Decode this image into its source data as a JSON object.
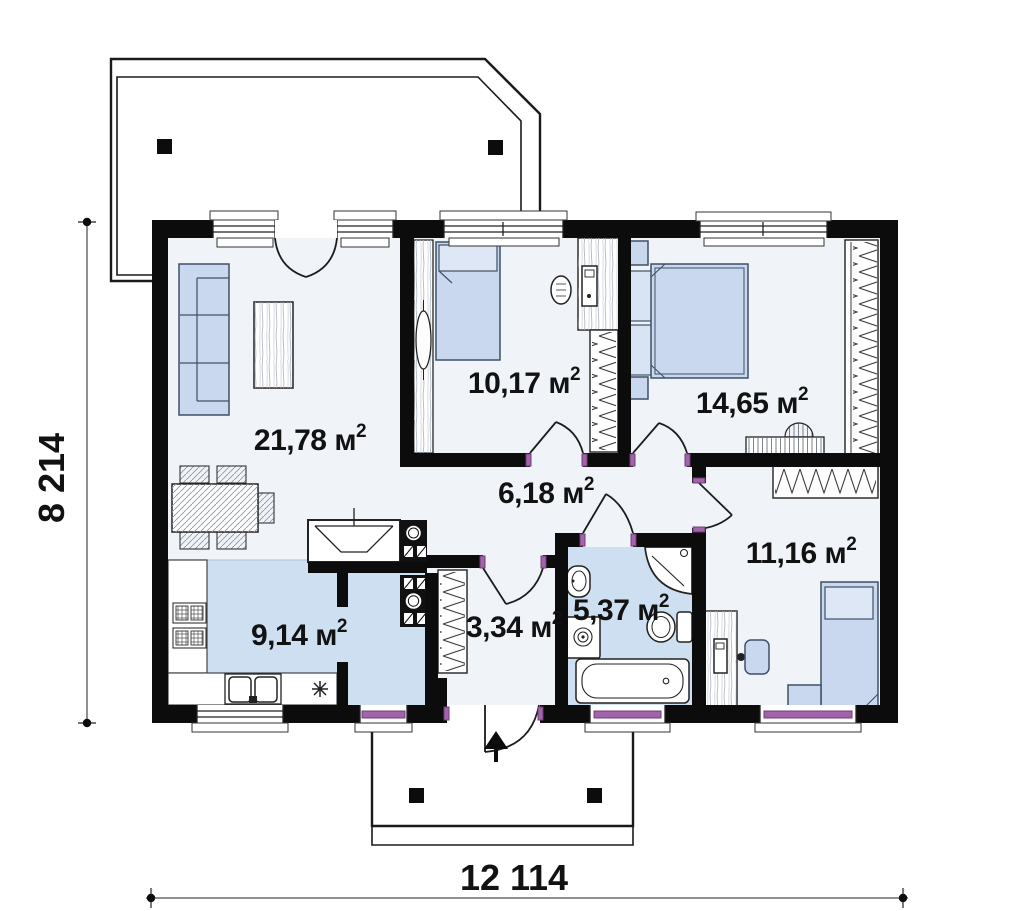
{
  "plan": {
    "rooms": {
      "living": {
        "label": "21,78 м",
        "sup": "2"
      },
      "bedroom1": {
        "label": "10,17 м",
        "sup": "2"
      },
      "bedroom2": {
        "label": "14,65 м",
        "sup": "2"
      },
      "hall": {
        "label": "6,18 м",
        "sup": "2"
      },
      "bedroom3": {
        "label": "11,16 м",
        "sup": "2"
      },
      "kitchen": {
        "label": "9,14 м",
        "sup": "2"
      },
      "vestibule": {
        "label": "3,34 м",
        "sup": "2"
      },
      "bathroom": {
        "label": "5,37 м",
        "sup": "2"
      }
    },
    "dimensions": {
      "height_label": "8 214",
      "width_label": "12 114"
    },
    "colors": {
      "wall": "#0c0c0c",
      "floor": "#f0f4f9",
      "wet_floor": "#cfdff2",
      "furniture": "#c9d8ee",
      "door_accent": "#a263ab"
    }
  }
}
